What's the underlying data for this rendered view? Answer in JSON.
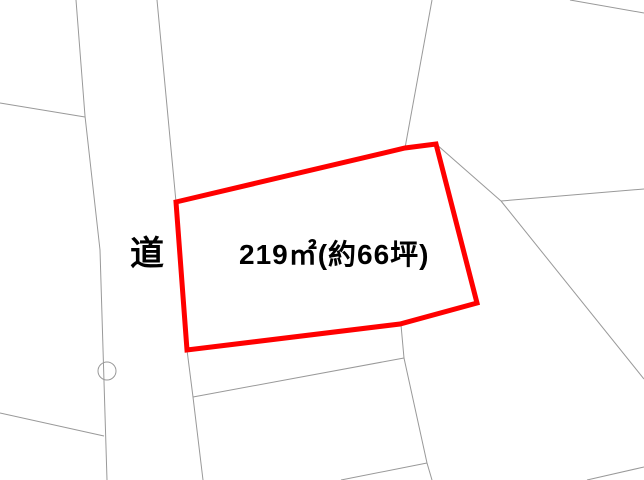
{
  "map": {
    "background_color": "#ffffff",
    "boundary_color": "#999999",
    "highlight_color": "#ff0000",
    "text_color": "#000000",
    "labels": {
      "road": "道",
      "area": "219㎡(約66坪)"
    },
    "parcel": {
      "area_m2": 219,
      "area_tsubo_approx": 66,
      "outline_points": "176,202 405,148 436,144 477,303 400,324 187,350",
      "outline_stroke_width": 5
    },
    "boundary_lines": [
      "76,0 85,116 100,250 107,480",
      "0,103 85,117",
      "0,413 104,436",
      "157,0 176,202",
      "187,350 193,397 203,480",
      "193,397 404,358",
      "401,325 404,358 427,463 432,480",
      "427,463 341,480",
      "432,0 405,148",
      "436,144 501,201",
      "501,201 644,189",
      "501,201 644,379",
      "570,0 644,13",
      "587,480 644,467"
    ],
    "survey_marker": {
      "cx": 107,
      "cy": 371,
      "r": 9
    }
  }
}
